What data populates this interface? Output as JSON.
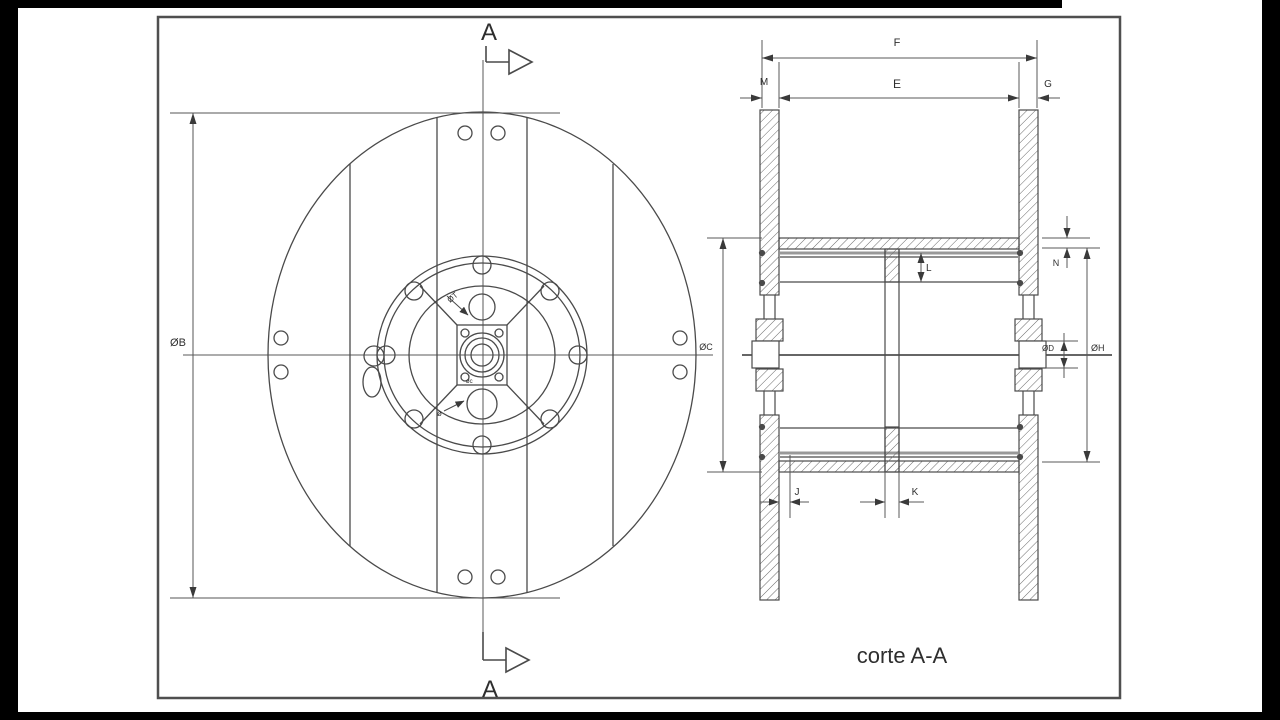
{
  "caption": "corte A-A",
  "section_markers": {
    "top": "A",
    "bottom": "A"
  },
  "front_dims": {
    "b": "ØB",
    "t": "ØT",
    "small_c": "øc",
    "small_o": "ø"
  },
  "section_dims": {
    "f": "F",
    "e": "E",
    "m": "M",
    "g": "G",
    "n": "N",
    "l": "L",
    "c": "ØC",
    "d": "ØD",
    "h": "ØH",
    "j": "J",
    "k": "K"
  },
  "colors": {
    "line": "#4a4a4a",
    "frame": "#4f4f4f",
    "thick_gray": "#999999",
    "letterbox": "#000000",
    "background": "#ffffff"
  }
}
